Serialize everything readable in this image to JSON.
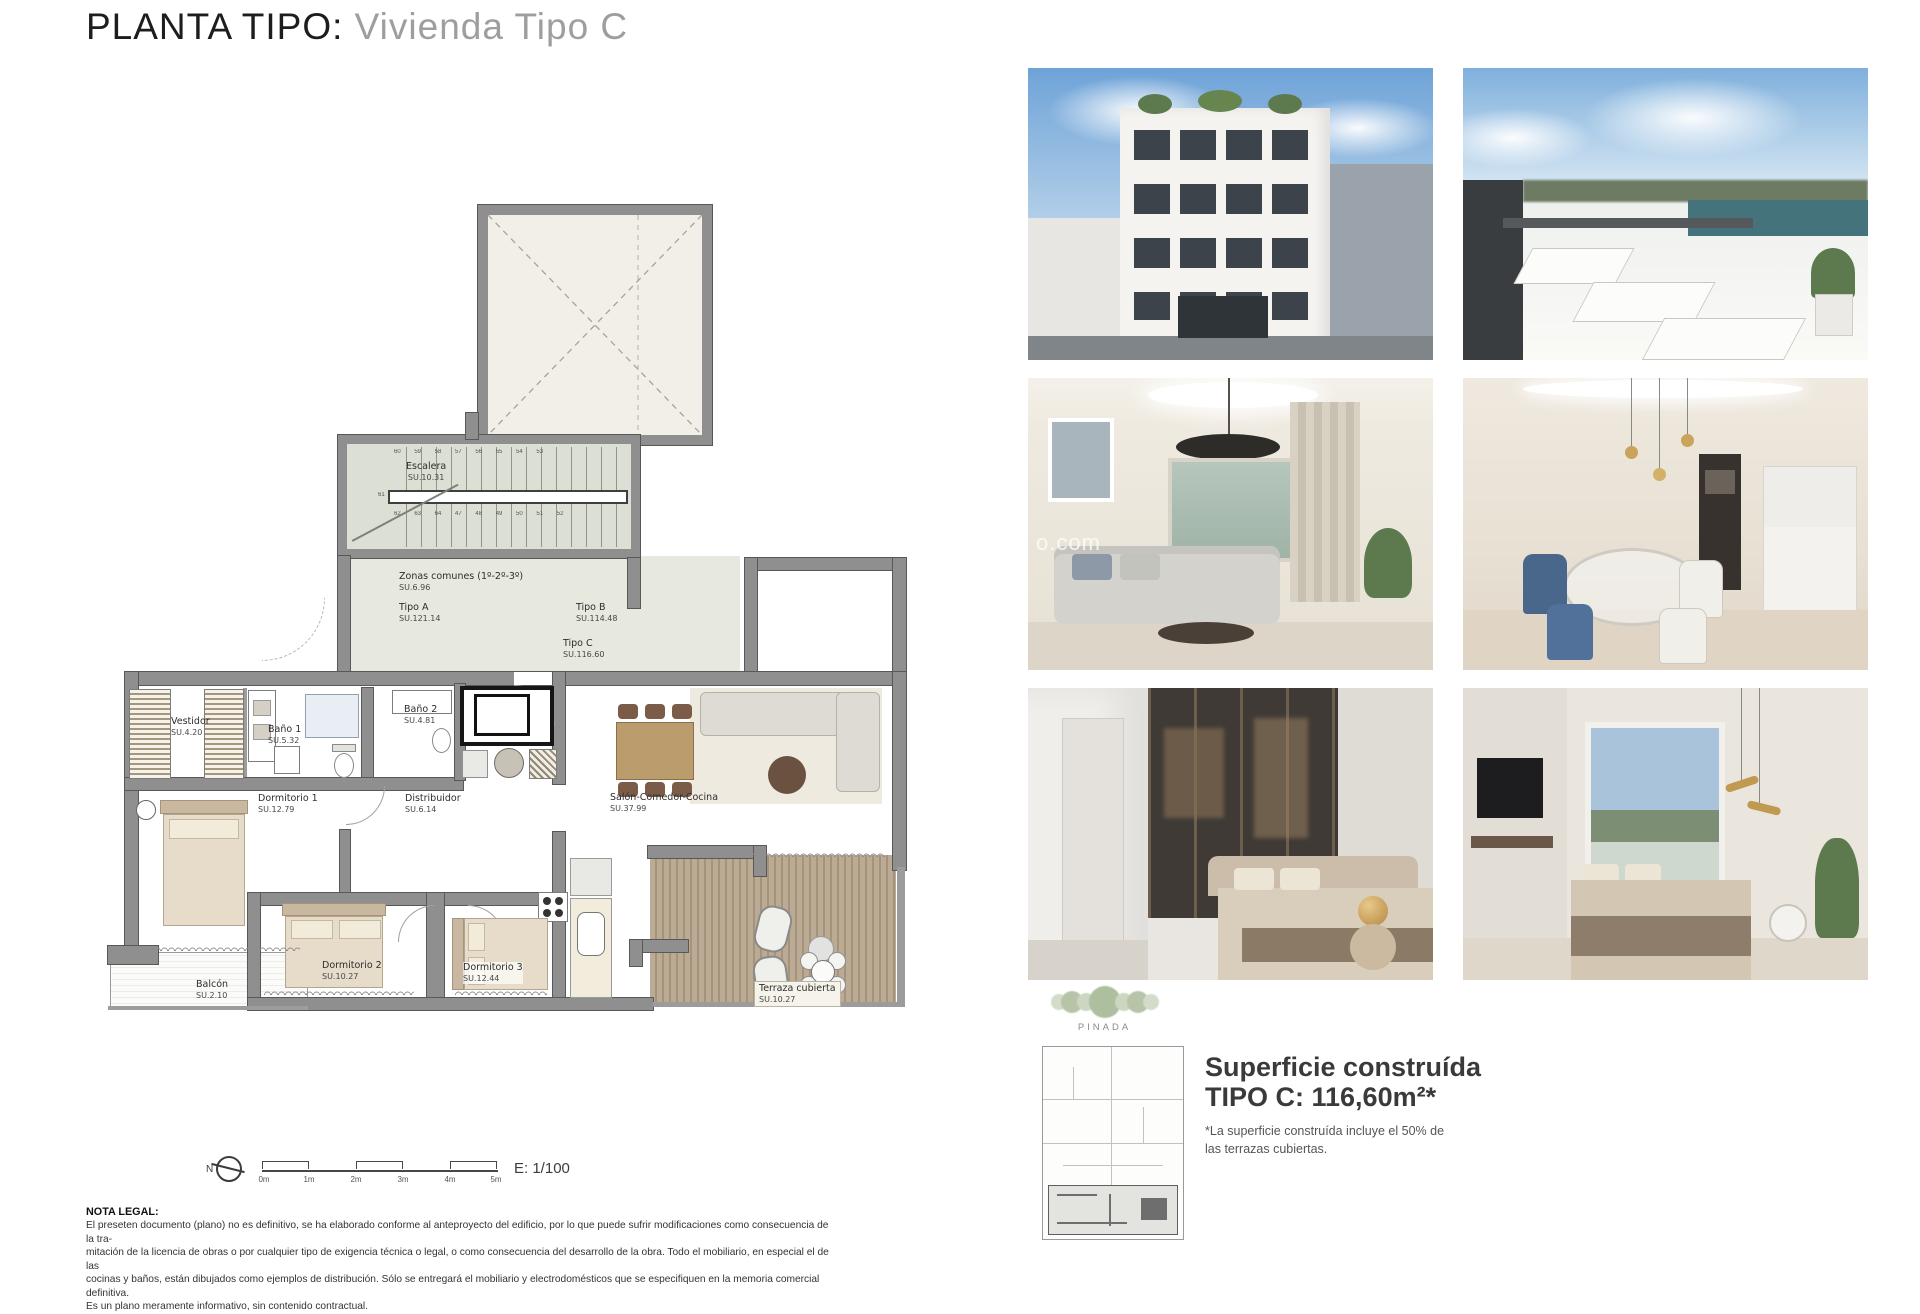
{
  "page": {
    "title": "PLANTA TIPO:",
    "subtitle": "Vivienda Tipo C"
  },
  "plan": {
    "rooms": {
      "escalera": {
        "name": "Escalera",
        "area": "SU.10.31"
      },
      "zonas": {
        "name": "Zonas comunes (1º-2º-3º)",
        "area": "SU.6.96"
      },
      "tipo_a": {
        "name": "Tipo A",
        "area": "SU.121.14"
      },
      "tipo_b": {
        "name": "Tipo B",
        "area": "SU.114.48"
      },
      "tipo_c": {
        "name": "Tipo C",
        "area": "SU.116.60"
      },
      "vestidor": {
        "name": "Vestidor",
        "area": "SU.4.20"
      },
      "bano1": {
        "name": "Baño 1",
        "area": "SU.5.32"
      },
      "bano2": {
        "name": "Baño 2",
        "area": "SU.4.81"
      },
      "dorm1": {
        "name": "Dormitorio 1",
        "area": "SU.12.79"
      },
      "distribuidor": {
        "name": "Distribuidor",
        "area": "SU.6.14"
      },
      "salon": {
        "name": "Salón-Comedor-Cocina",
        "area": "SU.37.99"
      },
      "dorm2": {
        "name": "Dormitorio 2",
        "area": "SU.10.27"
      },
      "dorm3": {
        "name": "Dormitorio 3",
        "area": "SU.12.44"
      },
      "balcon": {
        "name": "Balcón",
        "area": "SU.2.10"
      },
      "terraza": {
        "name": "Terraza cubierta",
        "area": "SU.10.27"
      }
    },
    "stairs": {
      "top_numbers": "60 59 58 57 56 55 54 53",
      "bottom_numbers": "62 63 64 47 48 49 50 51 52",
      "mid_number": "61"
    },
    "north_label": "N",
    "scale": {
      "ticks": [
        "0m",
        "1m",
        "2m",
        "3m",
        "4m",
        "5m"
      ],
      "label": "E: 1/100"
    }
  },
  "legal": {
    "heading": "NOTA LEGAL:",
    "lines": [
      "El preseten documento (plano) no es definitivo, se ha elaborado conforme al anteproyecto del edificio, por lo que puede sufrir modificaciones como consecuencia de la tra-",
      "mitación de la licencia de obras o por cualquier tipo de exigencia técnica o legal, o como consecuencia del desarrollo de la obra. Todo el mobiliario, en especial el de las",
      "cocinas y baños, están dibujados como ejemplos de distribución. Sólo se entregará el mobiliario y electrodomésticos que se especifiquen en la memoria comercial definitiva.",
      "Es un plano meramente informativo, sin contenido contractual."
    ]
  },
  "summary": {
    "brand": "PINADA",
    "title_line1": "Superficie construída",
    "title_line2": "TIPO C: 116,60m²*",
    "footnote_line1": "*La superficie construída incluye el 50% de",
    "footnote_line2": "las terrazas cubiertas."
  },
  "photos": {
    "watermark": "o.com"
  },
  "colors": {
    "wall_gray": "#8f8f8f",
    "stair_fill": "#dcdfd3",
    "corridor_fill": "#e7e9df",
    "deck_wood": "#b3a089",
    "title_gray": "#9e9e9e",
    "sky_blue": "#7aa9d6"
  }
}
